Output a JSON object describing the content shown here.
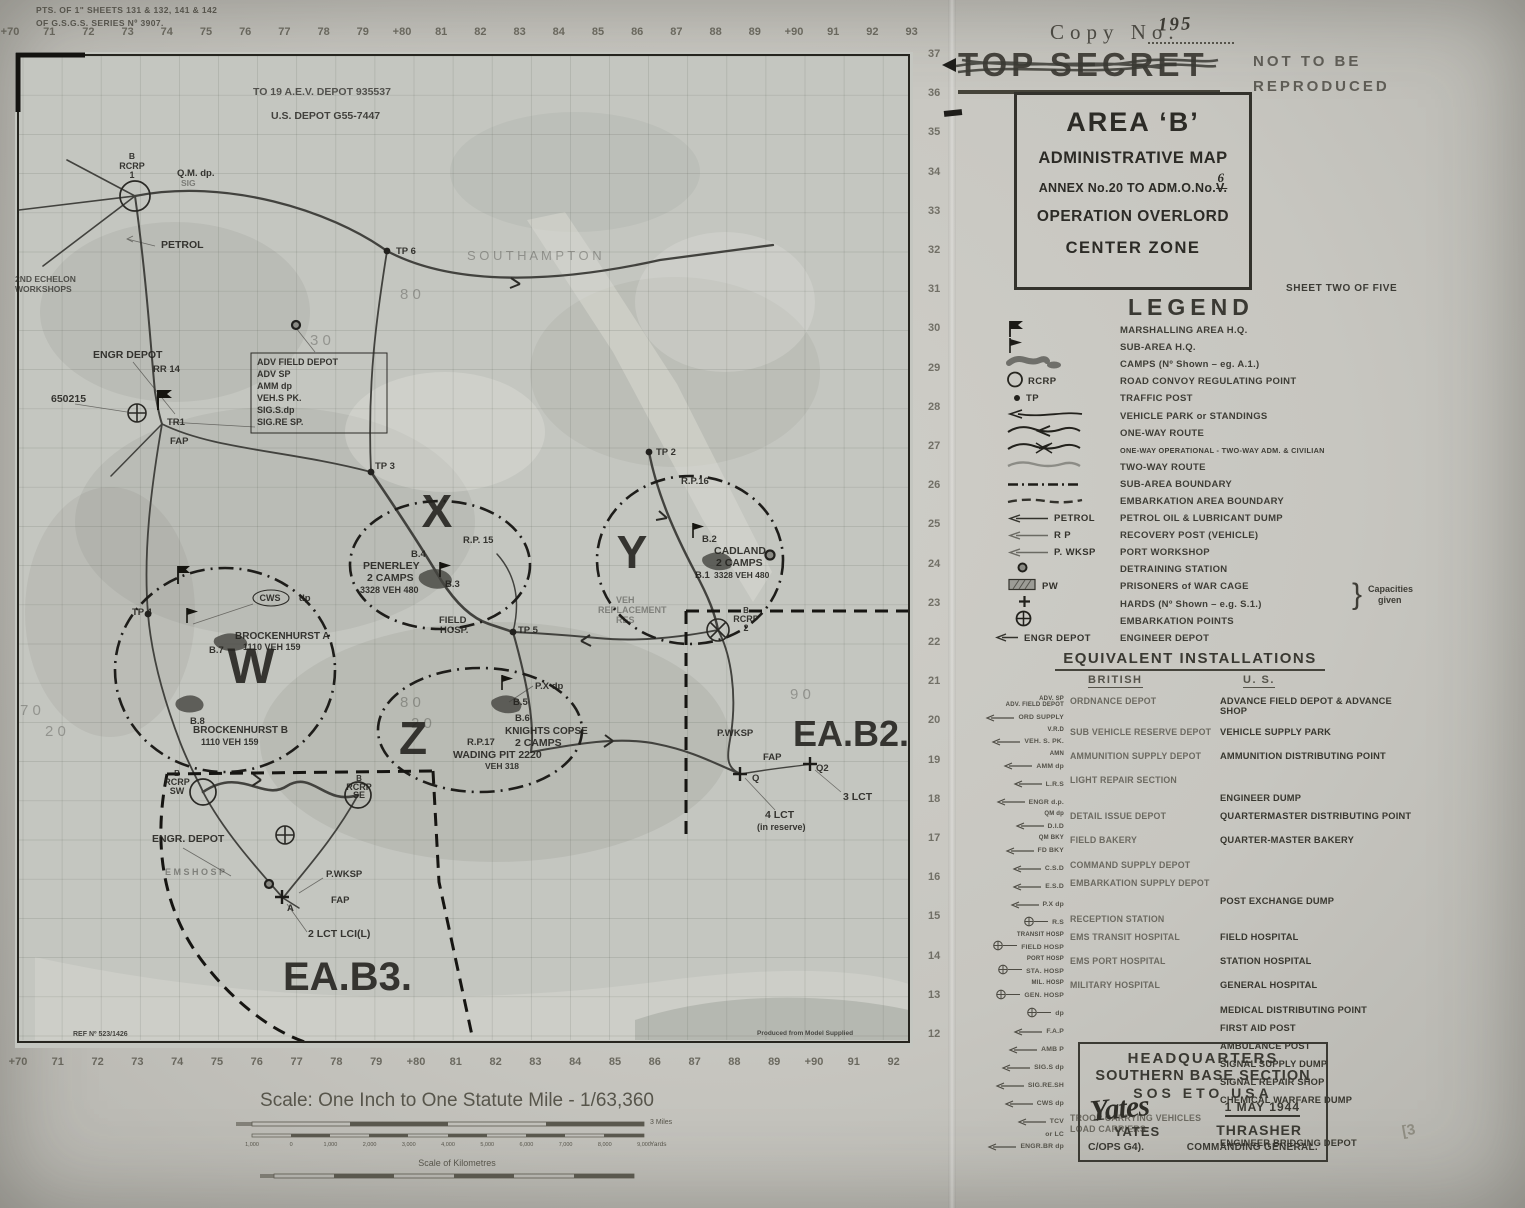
{
  "page": {
    "copy_label": "Copy  No.",
    "copy_value": "195",
    "classification": "TOP SECRET",
    "not_line1": "NOT  TO  BE",
    "not_line2": "REPRODUCED",
    "sheet_note": "SHEET TWO OF FIVE",
    "corner_note_line1": "PTS. OF 1\" SHEETS 131 & 132, 141 & 142",
    "corner_note_line2": "OF G.S.G.S. SERIES Nº 3907.",
    "pencil_mark": "[3"
  },
  "title_box": {
    "line1": "AREA ‘B’",
    "line2": "ADMINISTRATIVE MAP",
    "line3a": "ANNEX No.20 TO ADM.O.No.",
    "line3b": "V.",
    "line3_correction": "6",
    "line4": "OPERATION OVERLORD",
    "line5": "CENTER ZONE"
  },
  "legend": {
    "title": "LEGEND",
    "capacities_note_line1": "Capacities",
    "capacities_note_line2": "given",
    "items": [
      {
        "icon": "marshalling-flag-icon",
        "sym_label": "",
        "label": "MARSHALLING AREA H.Q."
      },
      {
        "icon": "sub-area-flag-icon",
        "sym_label": "",
        "label": "SUB-AREA H.Q."
      },
      {
        "icon": "camp-blob-icon",
        "sym_label": "",
        "label": "CAMPS  (Nº Shown  –  eg.  A.1.)"
      },
      {
        "icon": "circle-icon",
        "sym_label": "RCRP",
        "label": "ROAD CONVOY REGULATING POINT"
      },
      {
        "icon": "dot-icon",
        "sym_label": "TP",
        "label": "TRAFFIC  POST"
      },
      {
        "icon": "arrow-line-icon",
        "sym_label": "",
        "label": "VEHICLE  PARK  or  STANDINGS"
      },
      {
        "icon": "one-way-icon",
        "sym_label": "",
        "label": "ONE-WAY  ROUTE"
      },
      {
        "icon": "one-way-op-icon",
        "sym_label": "",
        "label": "ONE-WAY OPERATIONAL - TWO-WAY ADM. & CIVILIAN"
      },
      {
        "icon": "two-way-icon",
        "sym_label": "",
        "label": "TWO-WAY  ROUTE"
      },
      {
        "icon": "dash-dot-icon",
        "sym_label": "",
        "label": "SUB-AREA  BOUNDARY"
      },
      {
        "icon": "dashed-icon",
        "sym_label": "",
        "label": "EMBARKATION AREA BOUNDARY"
      },
      {
        "icon": "arrow-icon",
        "sym_label": "PETROL",
        "label": "PETROL OIL & LUBRICANT DUMP"
      },
      {
        "icon": "arrow-icon",
        "sym_label": "R P",
        "label": "RECOVERY POST  (VEHICLE)"
      },
      {
        "icon": "arrow-icon",
        "sym_label": "P. WKSP",
        "label": "PORT  WORKSHOP"
      },
      {
        "icon": "detraining-icon",
        "sym_label": "",
        "label": "DETRAINING  STATION"
      },
      {
        "icon": "pw-cage-icon",
        "sym_label": "PW",
        "label": "PRISONERS  of  WAR  CAGE"
      },
      {
        "icon": "plus-icon",
        "sym_label": "",
        "label": "HARDS  (Nº Shown – e.g. S.1.)"
      },
      {
        "icon": "circle-plus-icon",
        "sym_label": "",
        "label": "EMBARKATION  POINTS"
      },
      {
        "icon": "arrow-icon",
        "sym_label": "ENGR DEPOT",
        "label": "ENGINEER  DEPOT"
      }
    ]
  },
  "equivalents": {
    "title": "EQUIVALENT   INSTALLATIONS",
    "col_british": "BRITISH",
    "col_us": "U. S.",
    "rows": [
      {
        "sym": "arrow",
        "abbr": [
          "ADV. SP",
          "ADV. FIELD DEPOT"
        ],
        "tag": "ORD SUPPLY",
        "brit": "ORDNANCE  DEPOT",
        "us": "ADVANCE FIELD DEPOT & ADVANCE SHOP"
      },
      {
        "sym": "arrow",
        "abbr": [
          "V.R.D"
        ],
        "tag": "VEH. S. PK.",
        "brit": "SUB VEHICLE RESERVE DEPOT",
        "us": "VEHICLE  SUPPLY  PARK"
      },
      {
        "sym": "arrow",
        "abbr": [
          "AMN"
        ],
        "tag": "AMM dp",
        "brit": "AMMUNITION  SUPPLY  DEPOT",
        "us": "AMMUNITION DISTRIBUTING POINT"
      },
      {
        "sym": "arrow",
        "abbr": [],
        "tag": "L.R.S",
        "brit": "LIGHT REPAIR SECTION",
        "us": ""
      },
      {
        "sym": "arrow",
        "abbr": [],
        "tag": "ENGR d.p.",
        "brit": "",
        "us": "ENGINEER  DUMP"
      },
      {
        "sym": "arrow",
        "abbr": [
          "QM dp"
        ],
        "tag": "D.I.D",
        "brit": "DETAIL  ISSUE  DEPOT",
        "us": "QUARTERMASTER DISTRIBUTING POINT"
      },
      {
        "sym": "arrow",
        "abbr": [
          "QM BKY"
        ],
        "tag": "FD BKY",
        "brit": "FIELD  BAKERY",
        "us": "QUARTER-MASTER  BAKERY"
      },
      {
        "sym": "arrow",
        "abbr": [],
        "tag": "C.S.D",
        "brit": "COMMAND SUPPLY DEPOT",
        "us": ""
      },
      {
        "sym": "arrow",
        "abbr": [],
        "tag": "E.S.D",
        "brit": "EMBARKATION SUPPLY DEPOT",
        "us": ""
      },
      {
        "sym": "arrow",
        "abbr": [],
        "tag": "P.X dp",
        "brit": "",
        "us": "POST  EXCHANGE  DUMP"
      },
      {
        "sym": "oplus",
        "abbr": [],
        "tag": "R.S",
        "brit": "RECEPTION  STATION",
        "us": ""
      },
      {
        "sym": "oplus",
        "abbr": [
          "TRANSIT  HOSP"
        ],
        "tag": "FIELD HOSP",
        "brit": "EMS TRANSIT HOSPITAL",
        "us": "FIELD  HOSPITAL"
      },
      {
        "sym": "oplus",
        "abbr": [
          "PORT  HOSP"
        ],
        "tag": "STA. HOSP",
        "brit": "EMS  PORT  HOSPITAL",
        "us": "STATION  HOSPITAL"
      },
      {
        "sym": "oplus",
        "abbr": [
          "MIL. HOSP"
        ],
        "tag": "GEN. HOSP",
        "brit": "MILITARY  HOSPITAL",
        "us": "GENERAL  HOSPITAL"
      },
      {
        "sym": "oplus",
        "abbr": [],
        "tag": "dp",
        "brit": "",
        "us": "MEDICAL DISTRIBUTING POINT"
      },
      {
        "sym": "arrow",
        "abbr": [],
        "tag": "F.A.P",
        "brit": "",
        "us": "FIRST  AID  POST"
      },
      {
        "sym": "arrow",
        "abbr": [],
        "tag": "AMB P",
        "brit": "",
        "us": "AMBULANCE  POST"
      },
      {
        "sym": "arrow",
        "abbr": [],
        "tag": "SIG.S dp",
        "brit": "",
        "us": "SIGNAL  SUPPLY  DUMP"
      },
      {
        "sym": "arrow",
        "abbr": [],
        "tag": "SIG.RE.SH",
        "brit": "",
        "us": "SIGNAL  REPAIR  SHOP"
      },
      {
        "sym": "arrow",
        "abbr": [],
        "tag": "CWS dp",
        "brit": "",
        "us": "CHEMICAL  WARFARE  DUMP"
      },
      {
        "sym": "arrow",
        "abbr": [],
        "tag": "TCV",
        "tag2": "or LC",
        "brit": "TROOP CARRYING VEHICLES",
        "brit2": "LOAD  CARRIERS",
        "us": ""
      },
      {
        "sym": "arrow",
        "abbr": [],
        "tag": "ENGR.BR dp",
        "brit": "",
        "us": "ENGINEER  BRIDGING  DEPOT"
      }
    ]
  },
  "hq_box": {
    "line1": "HEADQUARTERS",
    "line2": "SOUTHERN  BASE  SECTION",
    "line3": "SOS   ETO   USA",
    "date": "1 MAY 1944",
    "signature": "Yates",
    "name_left": "YATES",
    "name_right": "THRASHER",
    "title_left": "C/OPS G4).",
    "title_right": "COMMANDING GENERAL."
  },
  "grid": {
    "top": [
      "+70",
      "71",
      "72",
      "73",
      "74",
      "75",
      "76",
      "77",
      "78",
      "79",
      "+80",
      "81",
      "82",
      "83",
      "84",
      "85",
      "86",
      "87",
      "88",
      "89",
      "+90",
      "91",
      "92",
      "93"
    ],
    "bottom": [
      "+70",
      "71",
      "72",
      "73",
      "74",
      "75",
      "76",
      "77",
      "78",
      "79",
      "+80",
      "81",
      "82",
      "83",
      "84",
      "85",
      "86",
      "87",
      "88",
      "89",
      "+90",
      "91",
      "92"
    ],
    "right": [
      "37",
      "36",
      "35",
      "34",
      "33",
      "32",
      "31",
      "30",
      "29",
      "28",
      "27",
      "26",
      "25",
      "24",
      "23",
      "22",
      "21",
      "20",
      "19",
      "18",
      "17",
      "16",
      "15",
      "14",
      "13",
      "12"
    ]
  },
  "scale": {
    "title": "Scale:  One Inch to One Statute Mile - 1/63,360",
    "miles_unit": "3 Miles",
    "yards_unit": "Yards",
    "yards_ticks": [
      "1,000",
      "0",
      "1,000",
      "2,000",
      "3,000",
      "4,000",
      "5,000",
      "6,000",
      "7,000",
      "8,000",
      "9,000"
    ],
    "km_label": "Scale of Kilometres"
  },
  "map": {
    "labels": [
      {
        "t": "TO 19 A.E.V. DEPOT   935537",
        "x": 238,
        "y": 43,
        "s": 10.5,
        "o": 0.7
      },
      {
        "t": "U.S. DEPOT  G55-7447",
        "x": 256,
        "y": 67,
        "s": 10.5,
        "o": 0.8
      },
      {
        "t": "B",
        "x": 117,
        "y": 107,
        "s": 8.5,
        "a": "m"
      },
      {
        "t": "RCRP",
        "x": 117,
        "y": 117,
        "s": 9,
        "a": "m"
      },
      {
        "t": "1",
        "x": 117,
        "y": 126,
        "s": 9,
        "a": "m"
      },
      {
        "t": "Q.M. dp.",
        "x": 162,
        "y": 124,
        "s": 9.5
      },
      {
        "t": "SIG",
        "x": 166,
        "y": 134,
        "s": 8.5,
        "o": 0.45
      },
      {
        "t": "PETROL",
        "x": 146,
        "y": 196,
        "s": 10.5
      },
      {
        "t": "2ND ECHELON",
        "x": 0,
        "y": 230,
        "s": 8.5,
        "o": 0.7
      },
      {
        "t": "WORKSHOPS",
        "x": 0,
        "y": 240,
        "s": 8.5,
        "o": 0.7
      },
      {
        "t": "TP 6",
        "x": 381,
        "y": 202,
        "s": 9.5
      },
      {
        "t": "S O U T H A M P T O N",
        "x": 452,
        "y": 208,
        "s": 13,
        "w": 400,
        "o": 0.32
      },
      {
        "t": "ENGR  DEPOT",
        "x": 78,
        "y": 306,
        "s": 10.5
      },
      {
        "t": "RR 14",
        "x": 138,
        "y": 320,
        "s": 9.5
      },
      {
        "t": "650215",
        "x": 36,
        "y": 350,
        "s": 10.5
      },
      {
        "t": "TR1",
        "x": 152,
        "y": 373,
        "s": 9.5
      },
      {
        "t": "FAP",
        "x": 155,
        "y": 392,
        "s": 9.5
      },
      {
        "t": "ADV FIELD DEPOT",
        "x": 242,
        "y": 313,
        "s": 9
      },
      {
        "t": "ADV SP",
        "x": 242,
        "y": 325,
        "s": 9
      },
      {
        "t": "AMM dp",
        "x": 242,
        "y": 337,
        "s": 9
      },
      {
        "t": "VEH.S PK.",
        "x": 242,
        "y": 349,
        "s": 9
      },
      {
        "t": "SIG.S.dp",
        "x": 242,
        "y": 361,
        "s": 9
      },
      {
        "t": "SIG.RE SP.",
        "x": 242,
        "y": 373,
        "s": 9
      },
      {
        "t": "TP 3",
        "x": 360,
        "y": 417,
        "s": 9.5
      },
      {
        "t": "TP 2",
        "x": 641,
        "y": 403,
        "s": 9.5
      },
      {
        "t": "R.P.16",
        "x": 666,
        "y": 432,
        "s": 9.5
      },
      {
        "t": "X",
        "x": 422,
        "y": 475,
        "s": 46,
        "w": 900,
        "a": "m",
        "big": true
      },
      {
        "t": "R.P. 15",
        "x": 448,
        "y": 491,
        "s": 9.5
      },
      {
        "t": "B.4",
        "x": 396,
        "y": 505,
        "s": 9.5
      },
      {
        "t": "PENERLEY",
        "x": 348,
        "y": 517,
        "s": 10.5
      },
      {
        "t": "2 CAMPS",
        "x": 352,
        "y": 529,
        "s": 10.5
      },
      {
        "t": "3328 VEH 480",
        "x": 345,
        "y": 541,
        "s": 9
      },
      {
        "t": "B.3",
        "x": 430,
        "y": 535,
        "s": 9.5
      },
      {
        "t": "FIELD",
        "x": 424,
        "y": 571,
        "s": 9.5
      },
      {
        "t": "HOSP.",
        "x": 425,
        "y": 581,
        "s": 9.5
      },
      {
        "t": "TP 5",
        "x": 503,
        "y": 581,
        "s": 9.5
      },
      {
        "t": "Y",
        "x": 617,
        "y": 516,
        "s": 46,
        "w": 900,
        "a": "m",
        "big": true
      },
      {
        "t": "B.2",
        "x": 687,
        "y": 490,
        "s": 9.5
      },
      {
        "t": "CADLAND",
        "x": 699,
        "y": 502,
        "s": 10.5
      },
      {
        "t": "2 CAMPS",
        "x": 701,
        "y": 514,
        "s": 10.5
      },
      {
        "t": "B.1",
        "x": 680,
        "y": 526,
        "s": 9.5
      },
      {
        "t": "3328 VEH 480",
        "x": 699,
        "y": 526,
        "s": 8.5
      },
      {
        "t": "VEH",
        "x": 601,
        "y": 551,
        "s": 9,
        "o": 0.42
      },
      {
        "t": "REPLACEMENT",
        "x": 583,
        "y": 561,
        "s": 9,
        "o": 0.42
      },
      {
        "t": "RES",
        "x": 601,
        "y": 571,
        "s": 9,
        "o": 0.42
      },
      {
        "t": "B",
        "x": 731,
        "y": 561,
        "s": 8,
        "a": "m"
      },
      {
        "t": "RCRP",
        "x": 731,
        "y": 570,
        "s": 9,
        "a": "m"
      },
      {
        "t": "2",
        "x": 731,
        "y": 579,
        "s": 9,
        "a": "m"
      },
      {
        "t": "W",
        "x": 236,
        "y": 631,
        "s": 50,
        "w": 900,
        "a": "m",
        "big": true
      },
      {
        "t": "TP 4",
        "x": 117,
        "y": 563,
        "s": 9.5
      },
      {
        "t": "CWS",
        "x": 255,
        "y": 549,
        "s": 9,
        "a": "m"
      },
      {
        "t": "dp",
        "x": 284,
        "y": 549,
        "s": 9.5
      },
      {
        "t": "BROCKENHURST  A",
        "x": 220,
        "y": 587,
        "s": 10
      },
      {
        "t": "1110     VEH 159",
        "x": 228,
        "y": 598,
        "s": 9
      },
      {
        "t": "B.7",
        "x": 194,
        "y": 601,
        "s": 9.5
      },
      {
        "t": "BROCKENHURST  B",
        "x": 178,
        "y": 681,
        "s": 10
      },
      {
        "t": "1110    VEH 159",
        "x": 186,
        "y": 693,
        "s": 9
      },
      {
        "t": "B.8",
        "x": 175,
        "y": 672,
        "s": 9.5
      },
      {
        "t": "Z",
        "x": 398,
        "y": 702,
        "s": 46,
        "w": 900,
        "a": "m",
        "big": true
      },
      {
        "t": "P.X dp",
        "x": 520,
        "y": 637,
        "s": 9.5
      },
      {
        "t": "B.5",
        "x": 498,
        "y": 653,
        "s": 9.5
      },
      {
        "t": "B.6",
        "x": 500,
        "y": 669,
        "s": 9.5
      },
      {
        "t": "KNIGHTS COPSE",
        "x": 490,
        "y": 682,
        "s": 10
      },
      {
        "t": "2 CAMPS",
        "x": 500,
        "y": 694,
        "s": 10.5
      },
      {
        "t": "R.P.17",
        "x": 452,
        "y": 693,
        "s": 9.5
      },
      {
        "t": "WADING PIT 2220",
        "x": 438,
        "y": 706,
        "s": 10.5
      },
      {
        "t": "VEH 318",
        "x": 470,
        "y": 717,
        "s": 8.5
      },
      {
        "t": "P.WKSP",
        "x": 702,
        "y": 684,
        "s": 9.5
      },
      {
        "t": "EA.B2.",
        "x": 778,
        "y": 694,
        "s": 36,
        "w": 900,
        "big": true
      },
      {
        "t": "FAP",
        "x": 748,
        "y": 708,
        "s": 9.5
      },
      {
        "t": "Q",
        "x": 737,
        "y": 729,
        "s": 9.5
      },
      {
        "t": "Q2",
        "x": 801,
        "y": 719,
        "s": 9.5
      },
      {
        "t": "3 LCT",
        "x": 828,
        "y": 748,
        "s": 10.5
      },
      {
        "t": "4 LCT",
        "x": 750,
        "y": 766,
        "s": 10.5
      },
      {
        "t": "(in reserve)",
        "x": 742,
        "y": 778,
        "s": 9
      },
      {
        "t": "B",
        "x": 162,
        "y": 724,
        "s": 8,
        "a": "m"
      },
      {
        "t": "RCRP",
        "x": 162,
        "y": 733,
        "s": 9,
        "a": "m"
      },
      {
        "t": "SW",
        "x": 162,
        "y": 742,
        "s": 9,
        "a": "m"
      },
      {
        "t": "B",
        "x": 344,
        "y": 729,
        "s": 8,
        "a": "m"
      },
      {
        "t": "RCRP",
        "x": 344,
        "y": 738,
        "s": 9,
        "a": "m"
      },
      {
        "t": "SE",
        "x": 344,
        "y": 746,
        "s": 9,
        "a": "m"
      },
      {
        "t": "ENGR. DEPOT",
        "x": 137,
        "y": 790,
        "s": 10.5
      },
      {
        "t": "E M S   H O S P",
        "x": 150,
        "y": 823,
        "s": 9,
        "o": 0.42
      },
      {
        "t": "P.WKSP",
        "x": 311,
        "y": 825,
        "s": 9.5
      },
      {
        "t": "FAP",
        "x": 316,
        "y": 851,
        "s": 9.5
      },
      {
        "t": "A",
        "x": 272,
        "y": 859,
        "s": 9.5
      },
      {
        "t": "2 LCT LCI(L)",
        "x": 293,
        "y": 885,
        "s": 10.5
      },
      {
        "t": "EA.B3.",
        "x": 268,
        "y": 938,
        "s": 40,
        "w": 900,
        "big": true
      },
      {
        "t": "REF Nº 523/1426",
        "x": 58,
        "y": 984,
        "s": 7,
        "o": 0.8
      },
      {
        "t": "Produced  from  Model  Supplied",
        "x": 742,
        "y": 983,
        "s": 6.5,
        "o": 0.75
      },
      {
        "t": "8 0",
        "x": 385,
        "y": 247,
        "s": 15,
        "w": 400,
        "o": 0.3
      },
      {
        "t": "3 0",
        "x": 295,
        "y": 293,
        "s": 15,
        "w": 400,
        "o": 0.3
      },
      {
        "t": "7 0",
        "x": 5,
        "y": 663,
        "s": 15,
        "w": 400,
        "o": 0.3
      },
      {
        "t": "2 0",
        "x": 30,
        "y": 684,
        "s": 15,
        "w": 400,
        "o": 0.3
      },
      {
        "t": "8 0",
        "x": 385,
        "y": 655,
        "s": 15,
        "w": 400,
        "o": 0.3
      },
      {
        "t": "2 0",
        "x": 396,
        "y": 676,
        "s": 15,
        "w": 400,
        "o": 0.3
      },
      {
        "t": "9 0",
        "x": 775,
        "y": 647,
        "s": 15,
        "w": 400,
        "o": 0.3
      }
    ]
  }
}
